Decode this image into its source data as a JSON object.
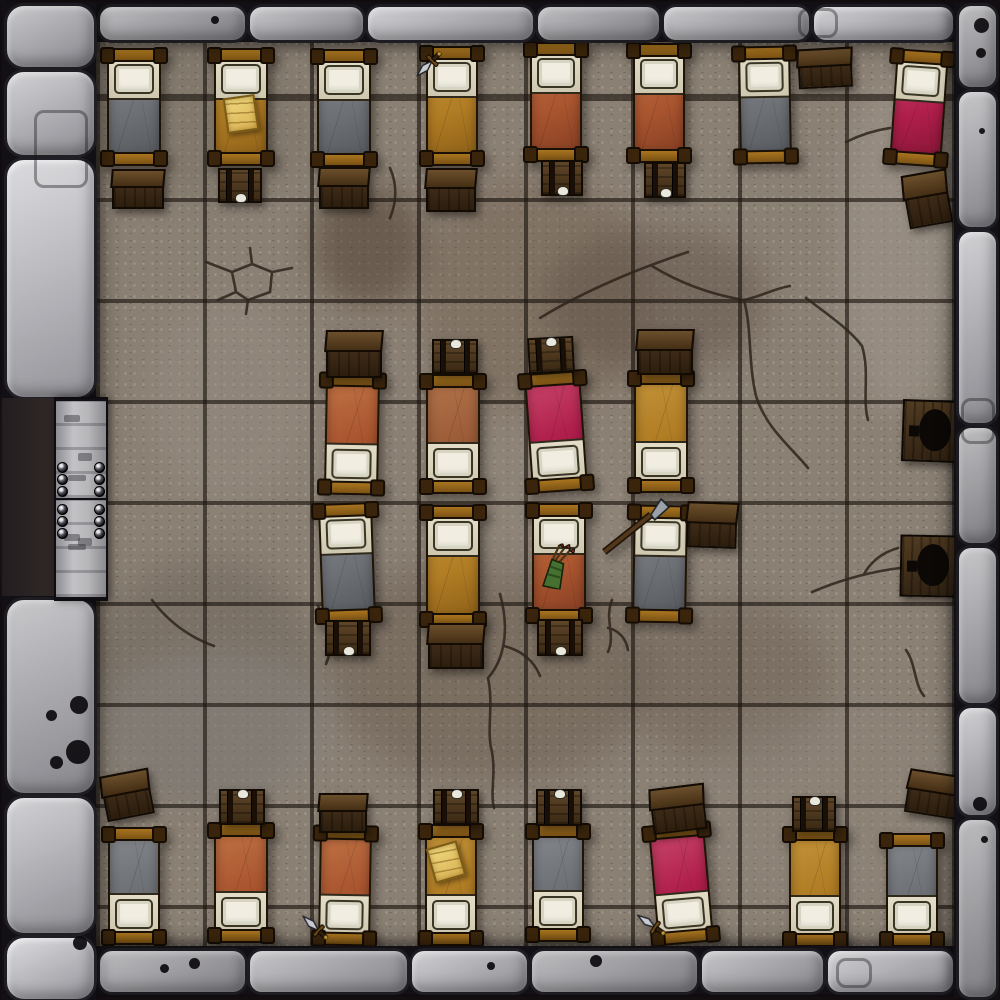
{
  "map": {
    "type": "dungeon-barracks-battle-map",
    "width": 1000,
    "height": 1000
  },
  "grid": {
    "columns": 8,
    "rows": 9,
    "cell_width": 107,
    "cell_height": 101
  },
  "colors": {
    "background": "#171114",
    "floor_base": "#8b8074",
    "grid_line": "#1a140e",
    "wall_stone": "#a9a9ad",
    "door_wood": "#b6b6b9",
    "bed_frame": "#96621c",
    "chest_wood": "#4c3720",
    "pillow": "#f1eee1",
    "blankets": {
      "gray": {
        "base": "#6d7075",
        "hi": "#7d8085",
        "sh": "#595c61"
      },
      "rust": {
        "base": "#a9552f",
        "hi": "#b96a3e",
        "sh": "#8c4225"
      },
      "ochre": {
        "base": "#b07c24",
        "hi": "#bd8c33",
        "sh": "#92641a"
      },
      "crimson": {
        "base": "#b01e4c",
        "hi": "#c03a60",
        "sh": "#8c1739"
      },
      "brown": {
        "base": "#9c5c38",
        "hi": "#ab6c45",
        "sh": "#7e4628"
      }
    }
  },
  "walls": [
    {
      "side": "top",
      "x": 96,
      "y": 2,
      "w": 858,
      "h": 40,
      "dir": "h",
      "stones": [
        150,
        118,
        170,
        126,
        150,
        144
      ]
    },
    {
      "side": "bottom",
      "x": 96,
      "y": 946,
      "w": 858,
      "h": 48,
      "dir": "h",
      "stones": [
        150,
        162,
        120,
        170,
        126,
        130
      ]
    },
    {
      "side": "right",
      "x": 954,
      "y": 2,
      "w": 44,
      "h": 996,
      "dir": "v",
      "stones": [
        86,
        140,
        196,
        120,
        160,
        112,
        182
      ]
    },
    {
      "side": "left-top",
      "x": 2,
      "y": 2,
      "w": 94,
      "h": 396,
      "dir": "v",
      "stones": [
        66,
        88,
        242
      ],
      "big": true
    },
    {
      "side": "left-bottom",
      "x": 2,
      "y": 596,
      "w": 94,
      "h": 404,
      "dir": "v",
      "stones": [
        198,
        140,
        66
      ],
      "big": true
    }
  ],
  "door": {
    "opening": {
      "x": 2,
      "y": 398,
      "w": 96,
      "h": 198
    },
    "leaf": {
      "x": 54,
      "y": 397,
      "w": 50,
      "h": 200
    },
    "panels": 2,
    "studs_per_cluster": 3
  },
  "beds": [
    {
      "id": "top-1",
      "x": 104,
      "y": 48,
      "w": 60,
      "h": 118,
      "rot": 0,
      "blanket": "gray",
      "pillow": "n",
      "items": []
    },
    {
      "id": "top-2",
      "x": 211,
      "y": 48,
      "w": 60,
      "h": 118,
      "rot": 0,
      "blanket": "ochre",
      "pillow": "n",
      "items": [
        {
          "type": "parchment",
          "dx": 14,
          "dy": 48,
          "rot": -8
        }
      ]
    },
    {
      "id": "top-3",
      "x": 314,
      "y": 49,
      "w": 60,
      "h": 118,
      "rot": 0,
      "blanket": "gray",
      "pillow": "n",
      "items": []
    },
    {
      "id": "top-4",
      "x": 423,
      "y": 46,
      "w": 58,
      "h": 120,
      "rot": 0,
      "blanket": "ochre",
      "pillow": "n",
      "items": [
        {
          "type": "dagger",
          "dx": -8,
          "dy": -2,
          "rot": -135
        }
      ]
    },
    {
      "id": "top-5",
      "x": 527,
      "y": 42,
      "w": 58,
      "h": 120,
      "rot": 0,
      "blanket": "rust",
      "pillow": "n",
      "items": []
    },
    {
      "id": "top-6",
      "x": 630,
      "y": 43,
      "w": 58,
      "h": 120,
      "rot": 0,
      "blanket": "rust",
      "pillow": "n",
      "items": []
    },
    {
      "id": "top-7",
      "x": 736,
      "y": 46,
      "w": 58,
      "h": 118,
      "rot": -1,
      "blanket": "gray",
      "pillow": "n",
      "items": []
    },
    {
      "id": "top-8",
      "x": 890,
      "y": 50,
      "w": 58,
      "h": 116,
      "rot": 4,
      "blanket": "crimson",
      "pillow": "n",
      "items": []
    },
    {
      "id": "mid-top-1",
      "x": 322,
      "y": 373,
      "w": 60,
      "h": 122,
      "rot": 1,
      "blanket": "rust",
      "pillow": "s",
      "items": []
    },
    {
      "id": "mid-top-2",
      "x": 423,
      "y": 374,
      "w": 60,
      "h": 120,
      "rot": 0,
      "blanket": "brown",
      "pillow": "s",
      "items": []
    },
    {
      "id": "mid-top-3",
      "x": 525,
      "y": 372,
      "w": 62,
      "h": 120,
      "rot": -4,
      "blanket": "crimson",
      "pillow": "s",
      "items": []
    },
    {
      "id": "mid-top-4",
      "x": 631,
      "y": 371,
      "w": 60,
      "h": 122,
      "rot": 0,
      "blanket": "ochre",
      "pillow": "s",
      "items": []
    },
    {
      "id": "mid-bot-1",
      "x": 317,
      "y": 503,
      "w": 60,
      "h": 120,
      "rot": -2,
      "blanket": "gray",
      "pillow": "n",
      "items": []
    },
    {
      "id": "mid-bot-2",
      "x": 423,
      "y": 505,
      "w": 60,
      "h": 122,
      "rot": 0,
      "blanket": "ochre",
      "pillow": "n",
      "items": []
    },
    {
      "id": "mid-bot-3",
      "x": 529,
      "y": 503,
      "w": 60,
      "h": 120,
      "rot": 0,
      "blanket": "rust",
      "pillow": "n",
      "items": [
        {
          "type": "quiver",
          "dx": 10,
          "dy": 40,
          "rot": 6
        }
      ]
    },
    {
      "id": "mid-bot-4",
      "x": 630,
      "y": 505,
      "w": 60,
      "h": 118,
      "rot": 1,
      "blanket": "gray",
      "pillow": "n",
      "items": [
        {
          "type": "spear",
          "dx": -32,
          "dy": -10,
          "rot": 0
        }
      ]
    },
    {
      "id": "bot-1",
      "x": 105,
      "y": 827,
      "w": 58,
      "h": 118,
      "rot": 0,
      "blanket": "gray",
      "pillow": "s",
      "items": []
    },
    {
      "id": "bot-2",
      "x": 211,
      "y": 823,
      "w": 60,
      "h": 120,
      "rot": 0,
      "blanket": "rust",
      "pillow": "s",
      "items": []
    },
    {
      "id": "bot-3",
      "x": 316,
      "y": 826,
      "w": 58,
      "h": 120,
      "rot": 1,
      "blanket": "rust",
      "pillow": "s",
      "items": [
        {
          "type": "dagger",
          "dx": -14,
          "dy": 84,
          "rot": -48
        }
      ]
    },
    {
      "id": "bot-4",
      "x": 422,
      "y": 824,
      "w": 58,
      "h": 122,
      "rot": 0,
      "blanket": "ochre",
      "pillow": "s",
      "items": [
        {
          "type": "parchment",
          "dx": 8,
          "dy": 20,
          "rot": -16
        }
      ]
    },
    {
      "id": "bot-5",
      "x": 529,
      "y": 824,
      "w": 58,
      "h": 118,
      "rot": 0,
      "blanket": "gray",
      "pillow": "s",
      "items": []
    },
    {
      "id": "bot-6",
      "x": 650,
      "y": 824,
      "w": 62,
      "h": 120,
      "rot": -5,
      "blanket": "crimson",
      "pillow": "s",
      "items": [
        {
          "type": "dagger",
          "dx": -16,
          "dy": 80,
          "rot": -50
        }
      ]
    },
    {
      "id": "bot-7",
      "x": 786,
      "y": 827,
      "w": 58,
      "h": 120,
      "rot": 0,
      "blanket": "ochre",
      "pillow": "s",
      "items": []
    },
    {
      "id": "bot-8",
      "x": 883,
      "y": 833,
      "w": 58,
      "h": 114,
      "rot": 0,
      "blanket": "gray",
      "pillow": "s",
      "items": []
    }
  ],
  "chests": [
    {
      "id": "t1",
      "x": 112,
      "y": 169,
      "w": 48,
      "h": 36,
      "rot": 0,
      "style": "crate"
    },
    {
      "id": "t2",
      "x": 218,
      "y": 168,
      "w": 40,
      "h": 31,
      "rot": 0,
      "style": "banded",
      "clasp": "bottom"
    },
    {
      "id": "t3",
      "x": 319,
      "y": 167,
      "w": 46,
      "h": 38,
      "rot": 0,
      "style": "crate"
    },
    {
      "id": "t4",
      "x": 426,
      "y": 168,
      "w": 46,
      "h": 40,
      "rot": 0,
      "style": "crate"
    },
    {
      "id": "t5",
      "x": 541,
      "y": 160,
      "w": 38,
      "h": 32,
      "rot": 0,
      "style": "banded",
      "clasp": "bottom"
    },
    {
      "id": "t6",
      "x": 644,
      "y": 162,
      "w": 38,
      "h": 32,
      "rot": 0,
      "style": "banded",
      "clasp": "bottom"
    },
    {
      "id": "t7",
      "x": 798,
      "y": 48,
      "w": 50,
      "h": 36,
      "rot": -3,
      "style": "crate"
    },
    {
      "id": "t8",
      "x": 905,
      "y": 172,
      "w": 40,
      "h": 50,
      "rot": -10,
      "style": "crate"
    },
    {
      "id": "mt1",
      "x": 326,
      "y": 330,
      "w": 52,
      "h": 44,
      "rot": 0,
      "style": "crate"
    },
    {
      "id": "mt2",
      "x": 432,
      "y": 339,
      "w": 42,
      "h": 31,
      "rot": 0,
      "style": "banded",
      "clasp": "top"
    },
    {
      "id": "mt3",
      "x": 528,
      "y": 337,
      "w": 42,
      "h": 32,
      "rot": -3,
      "style": "banded",
      "clasp": "top"
    },
    {
      "id": "mt4",
      "x": 637,
      "y": 329,
      "w": 52,
      "h": 42,
      "rot": 0,
      "style": "crate"
    },
    {
      "id": "mb1",
      "x": 325,
      "y": 620,
      "w": 42,
      "h": 32,
      "rot": 0,
      "style": "banded",
      "clasp": "bottom"
    },
    {
      "id": "mb2",
      "x": 428,
      "y": 623,
      "w": 52,
      "h": 42,
      "rot": 0,
      "style": "crate"
    },
    {
      "id": "mb3",
      "x": 537,
      "y": 619,
      "w": 42,
      "h": 33,
      "rot": 0,
      "style": "banded",
      "clasp": "bottom"
    },
    {
      "id": "mb4",
      "x": 687,
      "y": 502,
      "w": 46,
      "h": 42,
      "rot": 2,
      "style": "crate"
    },
    {
      "id": "b1",
      "x": 103,
      "y": 772,
      "w": 44,
      "h": 42,
      "rot": -11,
      "style": "crate"
    },
    {
      "id": "b2",
      "x": 219,
      "y": 789,
      "w": 42,
      "h": 32,
      "rot": 0,
      "style": "banded",
      "clasp": "top"
    },
    {
      "id": "b3",
      "x": 319,
      "y": 793,
      "w": 44,
      "h": 36,
      "rot": 0,
      "style": "crate"
    },
    {
      "id": "b4",
      "x": 433,
      "y": 789,
      "w": 42,
      "h": 32,
      "rot": 0,
      "style": "banded",
      "clasp": "top"
    },
    {
      "id": "b5",
      "x": 536,
      "y": 789,
      "w": 42,
      "h": 33,
      "rot": 0,
      "style": "banded",
      "clasp": "top"
    },
    {
      "id": "b6",
      "x": 651,
      "y": 786,
      "w": 50,
      "h": 42,
      "rot": -7,
      "style": "crate"
    },
    {
      "id": "b7",
      "x": 792,
      "y": 796,
      "w": 40,
      "h": 32,
      "rot": 0,
      "style": "banded",
      "clasp": "top"
    },
    {
      "id": "b8",
      "x": 907,
      "y": 772,
      "w": 48,
      "h": 40,
      "rot": 9,
      "style": "crate"
    }
  ],
  "privy_seats": [
    {
      "id": "privy-1",
      "x": 902,
      "y": 400,
      "w": 52,
      "h": 58,
      "rot": 2
    },
    {
      "id": "privy-2",
      "x": 900,
      "y": 535,
      "w": 52,
      "h": 58,
      "rot": 1
    }
  ]
}
